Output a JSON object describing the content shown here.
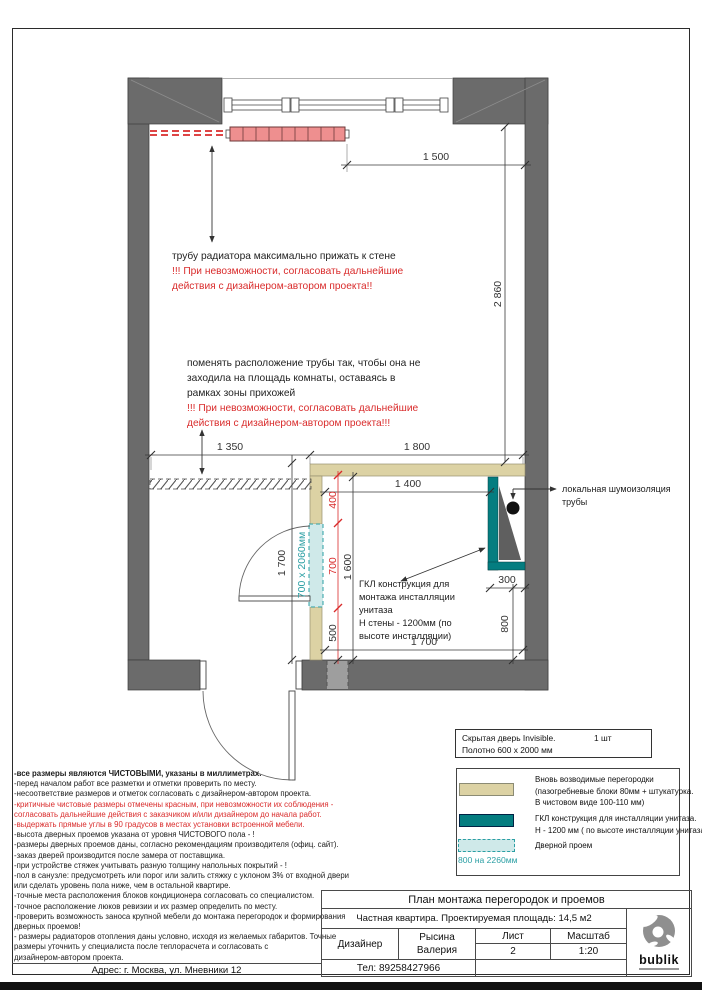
{
  "colors": {
    "wall": "#6b6b6b",
    "wall_light": "#9e9e9e",
    "partition": "#dcd2a4",
    "install": "#047d80",
    "opening": "#cfe9e9",
    "opening_cap": "#9fd4d6",
    "radiator": "#ee8f8f",
    "red": "#d92b2b",
    "teal_text": "#2b9fa4",
    "page_bar": "#111111"
  },
  "plan": {
    "dims": {
      "d1500": "1 500",
      "d2860": "2 860",
      "d1350": "1 350",
      "d1800": "1 800",
      "d1400": "1 400",
      "d400": "400",
      "d700": "700",
      "d500": "500",
      "d1600": "1 600",
      "d1700_door": "1 700",
      "d1700_bottom": "1 700",
      "d300": "300",
      "d800": "800"
    },
    "bath_door_size": "700 x 2060мм",
    "annotations": {
      "radiator_line1": "трубу радиатора максимально прижать к стене",
      "radiator_line2": "!!! При невозможности, согласовать дальнейшие",
      "radiator_line3": "действия с дизайнером-автором проекта!!",
      "pipe_line1": "поменять расположение трубы так, чтобы она не",
      "pipe_line2": "заходила на площадь комнаты, оставаясь в",
      "pipe_line3": "рамках зоны прихожей",
      "pipe_line4": "!!! При невозможности, согласовать дальнейшие",
      "pipe_line5": "действия с дизайнером-автором проекта!!!",
      "gkl_line1": "ГКЛ конструкция для",
      "gkl_line2": "монтажа инсталляции",
      "gkl_line3": "унитаза",
      "gkl_line4": "Н стены - 1200мм (по",
      "gkl_line5": "высоте инсталляции)",
      "sound_line1": "локальная шумоизоляция",
      "sound_line2": "трубы"
    }
  },
  "notes": {
    "lines": [
      {
        "text": "-все размеры являются ЧИСТОВЫМИ, указаны в миллиметрах.",
        "bold": true
      },
      {
        "text": "-перед началом работ все разметки и отметки проверить по месту."
      },
      {
        "text": "-несоответствие размеров и отметок согласовать с дизайнером-автором проекта."
      },
      {
        "text": "-критичные чистовые размеры отмечены красным, при невозможности их соблюдения -",
        "red": true
      },
      {
        "text": "согласовать дальнейшие действия с заказчиком и/или дизайнером до начала работ.",
        "red": true
      },
      {
        "text": "-выдержать прямые углы в 90 градусов в местах установки встроенной мебели.",
        "red": true
      },
      {
        "text": "-высота дверных проемов указана от уровня ЧИСТОВОГО пола - !"
      },
      {
        "text": "-размеры дверных проемов даны, согласно рекомендациям производителя (офиц. сайт)."
      },
      {
        "text": "-заказ дверей производится после замера от поставщика."
      },
      {
        "text": "-при устройстве стяжек учитывать разную толщину напольных покрытий - !"
      },
      {
        "text": "-пол в санузле: предусмотреть или порог или залить стяжку с уклоном 3% от входной двери"
      },
      {
        "text": "или сделать уровень пола ниже, чем в остальной квартире."
      },
      {
        "text": "-точные места расположения блоков кондиционера согласовать со специалистом."
      },
      {
        "text": "-точное расположение люков ревизии и их размер определить по месту."
      },
      {
        "text": "-проверить возможность заноса крупной мебели до монтажа перегородок и формирования"
      },
      {
        "text": "дверных проемов!"
      },
      {
        "text": "- размеры радиаторов отопления даны условно, исходя из желаемых габаритов. Точные"
      },
      {
        "text": "размеры уточнить у специалиста после теплорасчета и согласовать с"
      },
      {
        "text": "дизайнером-автором проекта."
      }
    ]
  },
  "address": "Адрес: г. Москва, ул. Мневники 12",
  "door_spec": {
    "name": "Скрытая дверь Invisible.",
    "qty": "1 шт",
    "leaf": "Полотно 600 x 2000 мм"
  },
  "legend": {
    "items": [
      {
        "line1": "Вновь возводимые перегородки",
        "line2": "(пазогребневые блоки 80мм + штукатурка.",
        "line3": "В чистовом виде 100-110 мм)"
      },
      {
        "line1": "ГКЛ конструкция для инсталляции унитаза.",
        "line2": "Н - 1200 мм ( по высоте инсталляции унитаза)"
      },
      {
        "line1": "Дверной проем",
        "size": "800 на 2260мм"
      }
    ]
  },
  "title_block": {
    "title": "План монтажа перегородок и проемов",
    "subtitle": "Частная квартира. Проектируемая площадь: 14,5 м2",
    "designer_label": "Дизайнер",
    "designer_first": "Рысина",
    "designer_last": "Валерия",
    "sheet_label": "Лист",
    "sheet_value": "2",
    "scale_label": "Масштаб",
    "scale_value": "1:20",
    "phone": "Тел: 89258427966",
    "logo": "bublik"
  }
}
